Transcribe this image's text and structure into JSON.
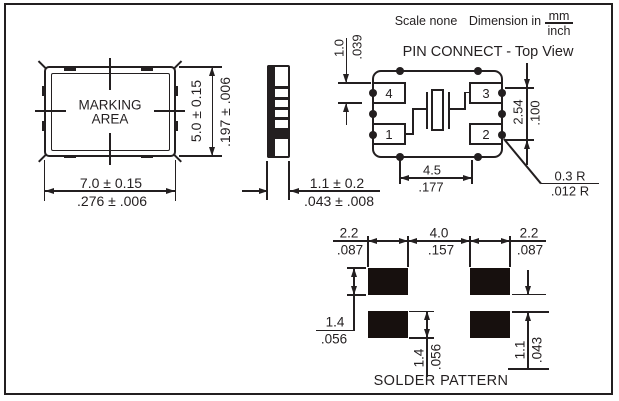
{
  "header": {
    "scale_label": "Scale none",
    "dimension_label": "Dimension in",
    "unit_mm": "mm",
    "unit_inch": "inch"
  },
  "package_view": {
    "marking_line1": "MARKING",
    "marking_line2": "AREA",
    "width": {
      "mm": "7.0 ± 0.15",
      "inch": ".276 ± .006"
    },
    "height": {
      "mm": "5.0 ± 0.15",
      "inch": ".197 ± .006"
    }
  },
  "side_view": {
    "thickness": {
      "mm": "1.1 ± 0.2",
      "inch": ".043 ± .008"
    }
  },
  "pin_connect": {
    "title": "PIN CONNECT - Top View",
    "pads": [
      {
        "label": "4"
      },
      {
        "label": "3"
      },
      {
        "label": "1"
      },
      {
        "label": "2"
      }
    ],
    "pad_height": {
      "mm": "1.0",
      "inch": ".039"
    },
    "pad_pitch": {
      "mm": "2.54",
      "inch": ".100"
    },
    "pad_span": {
      "mm": "4.5",
      "inch": ".177"
    },
    "corner_radius": {
      "mm": "0.3 R",
      "inch": ".012 R"
    }
  },
  "solder_pattern": {
    "title": "SOLDER PATTERN",
    "pad_width_left": {
      "mm": "2.2",
      "inch": ".087"
    },
    "pad_spacing": {
      "mm": "4.0",
      "inch": ".157"
    },
    "pad_width_right": {
      "mm": "2.2",
      "inch": ".087"
    },
    "pad_height_upper": {
      "mm": "1.4",
      "inch": ".056"
    },
    "pad_height_lower": {
      "mm": "1.4",
      "inch": ".056"
    },
    "row_gap": {
      "mm": "1.1",
      "inch": ".043"
    }
  },
  "colors": {
    "line": "#231f20",
    "pad_fill": "#17100e",
    "background": "#ffffff"
  }
}
